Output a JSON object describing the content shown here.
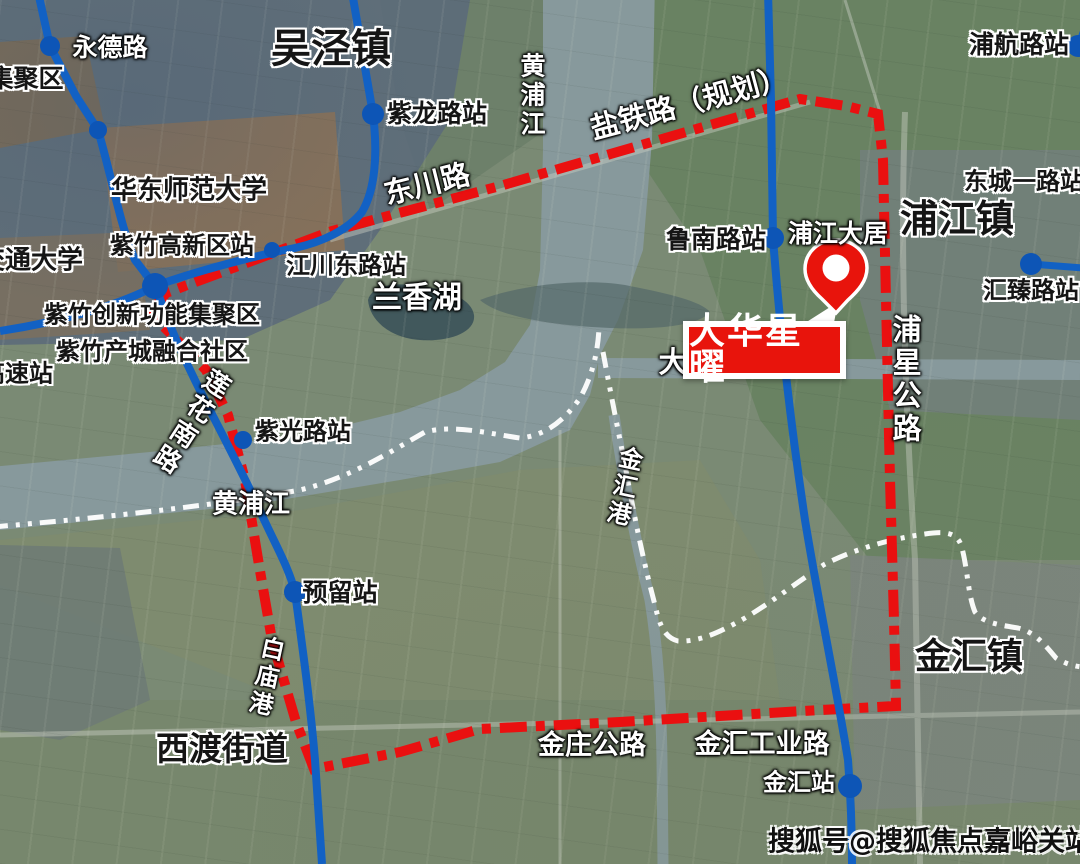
{
  "colors": {
    "boundary_red": "#ea1010",
    "metro_blue": "#1261c4",
    "station_dot_blue": "#0d55b6",
    "channel_white": "#ffffff",
    "marker_red": "#e8140c"
  },
  "marker": {
    "label": "大华星曜"
  },
  "watermark": {
    "text": "搜狐号@搜狐焦点嘉峪关站"
  },
  "labels": [
    {
      "id": "jijuqu",
      "text": "集聚区",
      "x": 26,
      "y": 79,
      "size": 25,
      "style": "black"
    },
    {
      "id": "yongde-road",
      "text": "永德路",
      "x": 110,
      "y": 48,
      "size": 25,
      "style": "white"
    },
    {
      "id": "wujing-town",
      "text": "吴泾镇",
      "x": 331,
      "y": 50,
      "size": 40,
      "style": "black"
    },
    {
      "id": "zilong-station",
      "text": "紫龙路站",
      "x": 437,
      "y": 114,
      "size": 25,
      "style": "black"
    },
    {
      "id": "huangpu-river-north",
      "text": "黄浦江",
      "x": 531,
      "y": 96,
      "size": 25,
      "style": "white",
      "vertical": true
    },
    {
      "id": "yantie-railway",
      "text": "盐铁路（规划）",
      "x": 689,
      "y": 103,
      "size": 29,
      "style": "white",
      "rot": -15
    },
    {
      "id": "dongchuan-road",
      "text": "东川路",
      "x": 427,
      "y": 184,
      "size": 29,
      "style": "white",
      "rot": -14
    },
    {
      "id": "puhang-station",
      "text": "浦航路站",
      "x": 1019,
      "y": 45,
      "size": 25,
      "style": "black"
    },
    {
      "id": "dongcheng-station",
      "text": "东城一路站",
      "x": 1024,
      "y": 182,
      "size": 24,
      "style": "black"
    },
    {
      "id": "pujiang-town",
      "text": "浦江镇",
      "x": 957,
      "y": 220,
      "size": 38,
      "style": "black"
    },
    {
      "id": "huizhen-station",
      "text": "汇臻路站",
      "x": 1031,
      "y": 291,
      "size": 24,
      "style": "black"
    },
    {
      "id": "hdnu-university",
      "text": "华东师范大学",
      "x": 189,
      "y": 191,
      "size": 26,
      "style": "black"
    },
    {
      "id": "jiaotong-university",
      "text": "交通大学",
      "x": 31,
      "y": 261,
      "size": 26,
      "style": "black"
    },
    {
      "id": "zizhu-hitech-station",
      "text": "紫竹高新区站",
      "x": 182,
      "y": 246,
      "size": 24,
      "style": "black"
    },
    {
      "id": "jiangchuan-station",
      "text": "江川东路站",
      "x": 346,
      "y": 266,
      "size": 24,
      "style": "black"
    },
    {
      "id": "zizhu-cluster",
      "text": "紫竹创新功能集聚区",
      "x": 152,
      "y": 315,
      "size": 24,
      "style": "black"
    },
    {
      "id": "zizhu-city",
      "text": "紫竹产城融合社区",
      "x": 152,
      "y": 352,
      "size": 24,
      "style": "black"
    },
    {
      "id": "gaosu-station",
      "text": "高速站",
      "x": 17,
      "y": 374,
      "size": 24,
      "style": "black"
    },
    {
      "id": "lanxiang-lake",
      "text": "兰香湖",
      "x": 417,
      "y": 298,
      "size": 30,
      "style": "white"
    },
    {
      "id": "lunan-station",
      "text": "鲁南路站",
      "x": 716,
      "y": 240,
      "size": 25,
      "style": "black"
    },
    {
      "id": "pujiang-daju",
      "text": "浦江大居",
      "x": 838,
      "y": 234,
      "size": 25,
      "style": "white"
    },
    {
      "id": "puxing-road",
      "text": "浦星公路",
      "x": 905,
      "y": 380,
      "size": 29,
      "style": "white",
      "vertical": true
    },
    {
      "id": "dazhi-river",
      "text": "大",
      "x": 673,
      "y": 362,
      "size": 29,
      "style": "white"
    },
    {
      "id": "lianhua-road",
      "text": "莲花南路",
      "x": 189,
      "y": 421,
      "size": 26,
      "style": "white",
      "vertical": true,
      "rot": 33
    },
    {
      "id": "ziguang-station",
      "text": "紫光路站",
      "x": 303,
      "y": 432,
      "size": 24,
      "style": "black"
    },
    {
      "id": "huangpu-river-west",
      "text": "黄浦江",
      "x": 251,
      "y": 505,
      "size": 26,
      "style": "white"
    },
    {
      "id": "jinhui-canal",
      "text": "金汇港",
      "x": 622,
      "y": 487,
      "size": 24,
      "style": "white",
      "vertical": true,
      "rot": 12
    },
    {
      "id": "yuliu-station",
      "text": "预留站",
      "x": 340,
      "y": 593,
      "size": 25,
      "style": "black"
    },
    {
      "id": "baimiao-canal",
      "text": "白庙港",
      "x": 264,
      "y": 677,
      "size": 24,
      "style": "white",
      "vertical": true,
      "rot": 12
    },
    {
      "id": "xidu-town",
      "text": "西渡街道",
      "x": 222,
      "y": 749,
      "size": 33,
      "style": "black"
    },
    {
      "id": "jinhui-town",
      "text": "金汇镇",
      "x": 969,
      "y": 657,
      "size": 36,
      "style": "black"
    },
    {
      "id": "jinzhuang-road",
      "text": "金庄公路",
      "x": 592,
      "y": 746,
      "size": 27,
      "style": "white"
    },
    {
      "id": "jinhui-industrial-road",
      "text": "金汇工业路",
      "x": 762,
      "y": 745,
      "size": 27,
      "style": "white"
    },
    {
      "id": "jinhui-station",
      "text": "金汇站",
      "x": 799,
      "y": 783,
      "size": 24,
      "style": "white"
    }
  ],
  "stations": [
    {
      "id": "yongde-dot",
      "x": 50,
      "y": 46,
      "r": 10
    },
    {
      "id": "mid-dot",
      "x": 98,
      "y": 130,
      "r": 9
    },
    {
      "id": "zilong-dot",
      "x": 373,
      "y": 114,
      "r": 11
    },
    {
      "id": "jiangchuan-dot",
      "x": 272,
      "y": 250,
      "r": 8
    },
    {
      "id": "junction-dot",
      "x": 155,
      "y": 286,
      "r": 13
    },
    {
      "id": "ziguang-dot",
      "x": 243,
      "y": 440,
      "r": 9
    },
    {
      "id": "yuliu-dot",
      "x": 295,
      "y": 592,
      "r": 11
    },
    {
      "id": "lunan-dot",
      "x": 773,
      "y": 238,
      "r": 11
    },
    {
      "id": "puhang-dot",
      "x": 1078,
      "y": 46,
      "r": 11
    },
    {
      "id": "huizhen-dot",
      "x": 1031,
      "y": 264,
      "r": 11
    },
    {
      "id": "jinhui-dot",
      "x": 850,
      "y": 786,
      "r": 12
    }
  ]
}
